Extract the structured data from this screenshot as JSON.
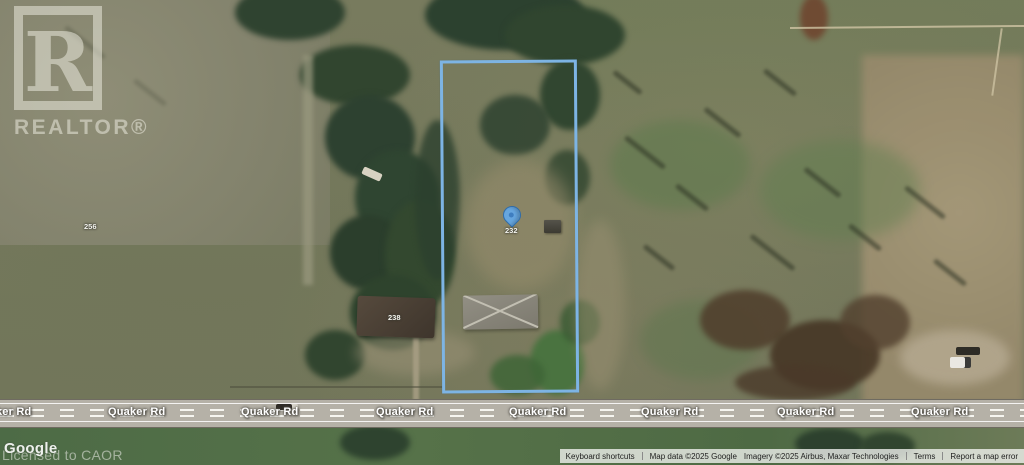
{
  "map": {
    "road": {
      "name": "Quaker Rd"
    },
    "parcel_labels": {
      "left_house": "256",
      "neighbor_house": "238",
      "subject_pin": "232"
    },
    "marker_color": "#66a6df",
    "boundary_color": "#7db4e4"
  },
  "watermark": {
    "realtor_r": "R",
    "realtor_word": "REALTOR®",
    "licensed": "Licensed to CAOR"
  },
  "google_logo": "Google",
  "attribution": {
    "keyboard_shortcuts": "Keyboard shortcuts",
    "map_data": "Map data ©2025 Google",
    "imagery": "Imagery ©2025 Airbus, Maxar Technologies",
    "terms": "Terms",
    "report_error": "Report a map error"
  }
}
